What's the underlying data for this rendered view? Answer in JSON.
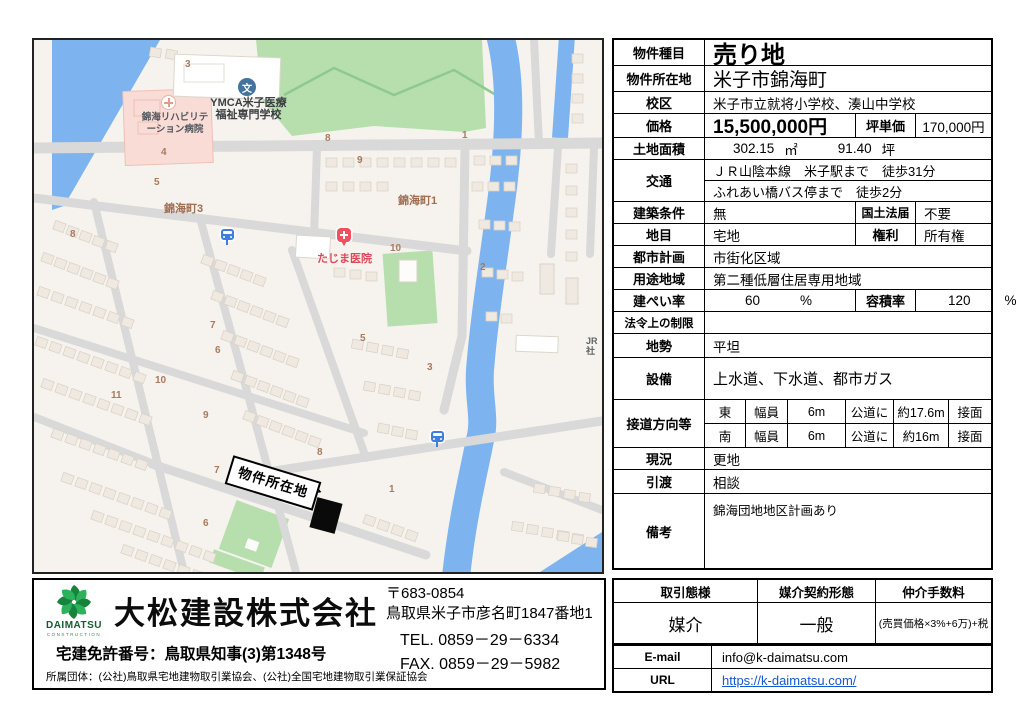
{
  "map": {
    "poi": {
      "school_icon_glyph": "文",
      "school_line1": "YMCA米子医療",
      "school_line2": "福祉専門学校",
      "rehab_line1": "錦海リハビリテ",
      "rehab_line2": "ーション病院",
      "clinic": "たじま医院",
      "district3": "錦海町3",
      "district1": "錦海町1",
      "jr_line1": "JR",
      "jr_line2": "社",
      "property_label": "物件所在地"
    },
    "block_numbers": [
      {
        "t": "3",
        "x": 151,
        "y": 19
      },
      {
        "t": "8",
        "x": 291,
        "y": 93
      },
      {
        "t": "9",
        "x": 323,
        "y": 115
      },
      {
        "t": "1",
        "x": 428,
        "y": 90
      },
      {
        "t": "4",
        "x": 127,
        "y": 107
      },
      {
        "t": "5",
        "x": 120,
        "y": 137
      },
      {
        "t": "8",
        "x": 36,
        "y": 189
      },
      {
        "t": "10",
        "x": 356,
        "y": 203
      },
      {
        "t": "2",
        "x": 446,
        "y": 222
      },
      {
        "t": "5",
        "x": 326,
        "y": 293
      },
      {
        "t": "3",
        "x": 393,
        "y": 322
      },
      {
        "t": "7",
        "x": 176,
        "y": 280
      },
      {
        "t": "6",
        "x": 181,
        "y": 305
      },
      {
        "t": "10",
        "x": 121,
        "y": 335
      },
      {
        "t": "11",
        "x": 77,
        "y": 350
      },
      {
        "t": "9",
        "x": 169,
        "y": 370
      },
      {
        "t": "7",
        "x": 180,
        "y": 425
      },
      {
        "t": "8",
        "x": 283,
        "y": 407
      },
      {
        "t": "1",
        "x": 355,
        "y": 444
      },
      {
        "t": "6",
        "x": 169,
        "y": 478
      }
    ],
    "colors": {
      "water": "#7db4f0",
      "park": "#b7dfae",
      "road": "#d9d9d9",
      "building": "#efe9e1",
      "hospital_block": "#f9dcd6"
    }
  },
  "details": {
    "type_label": "物件種目",
    "type_value": "売り地",
    "location_label": "物件所在地",
    "location_value": "米子市錦海町",
    "school_label": "校区",
    "school_value": "米子市立就将小学校、湊山中学校",
    "price_label": "価格",
    "price_value": "15,500,000円",
    "unit_price_label": "坪単価",
    "unit_price_value": "170,000円",
    "area_label": "土地面積",
    "area_m2": "302.15",
    "area_m2_unit": "㎡",
    "area_tsubo": "91.40",
    "area_tsubo_unit": "坪",
    "access_label": "交通",
    "access_line1": "ＪＲ山陰本線　米子駅まで　徒歩31分",
    "access_line2": "ふれあい橋バス停まで　徒歩2分",
    "building_cond_label": "建築条件",
    "building_cond_value": "無",
    "land_act_label": "国土法届",
    "land_act_value": "不要",
    "land_cat_label": "地目",
    "land_cat_value": "宅地",
    "rights_label": "権利",
    "rights_value": "所有権",
    "city_plan_label": "都市計画",
    "city_plan_value": "市街化区域",
    "zoning_label": "用途地域",
    "zoning_value": "第二種低層住居専用地域",
    "bcr_label": "建ぺい率",
    "bcr_value": "60",
    "bcr_unit": "%",
    "far_label": "容積率",
    "far_value": "120",
    "far_unit": "%",
    "legal_label": "法令上の制限",
    "legal_value": "",
    "terrain_label": "地勢",
    "terrain_value": "平坦",
    "utilities_label": "設備",
    "utilities_value": "上水道、下水道、都市ガス",
    "road_label": "接道方向等",
    "road_rows": [
      [
        "東",
        "幅員",
        "6m",
        "公道に",
        "約17.6m",
        "接面"
      ],
      [
        "南",
        "幅員",
        "6m",
        "公道に",
        "約16m",
        "接面"
      ]
    ],
    "status_label": "現況",
    "status_value": "更地",
    "handover_label": "引渡",
    "handover_value": "相談",
    "remarks_label": "備考",
    "remarks_value": "錦海団地地区計画あり"
  },
  "transaction": {
    "headers": [
      "取引態様",
      "媒介契約形態",
      "仲介手数料"
    ],
    "values": [
      "媒介",
      "一般",
      "(売買価格×3%+6万)+税"
    ],
    "email_label": "E-mail",
    "email_value": "info@k-daimatsu.com",
    "url_label": "URL",
    "url_value": "https://k-daimatsu.com/"
  },
  "company": {
    "logo_text": "DAIMATSU",
    "logo_sub": "CONSTRUCTION",
    "name": "大松建設株式会社",
    "license": "宅建免許番号：鳥取県知事(3)第1348号",
    "associations": "所属団体：(公社)鳥取県宅地建物取引業協会、(公社)全国宅地建物取引業保証協会",
    "postal": "〒683-0854",
    "address": "鳥取県米子市彦名町1847番地1",
    "tel": "TEL. 0859－29－6334",
    "fax": "FAX. 0859－29－5982"
  }
}
